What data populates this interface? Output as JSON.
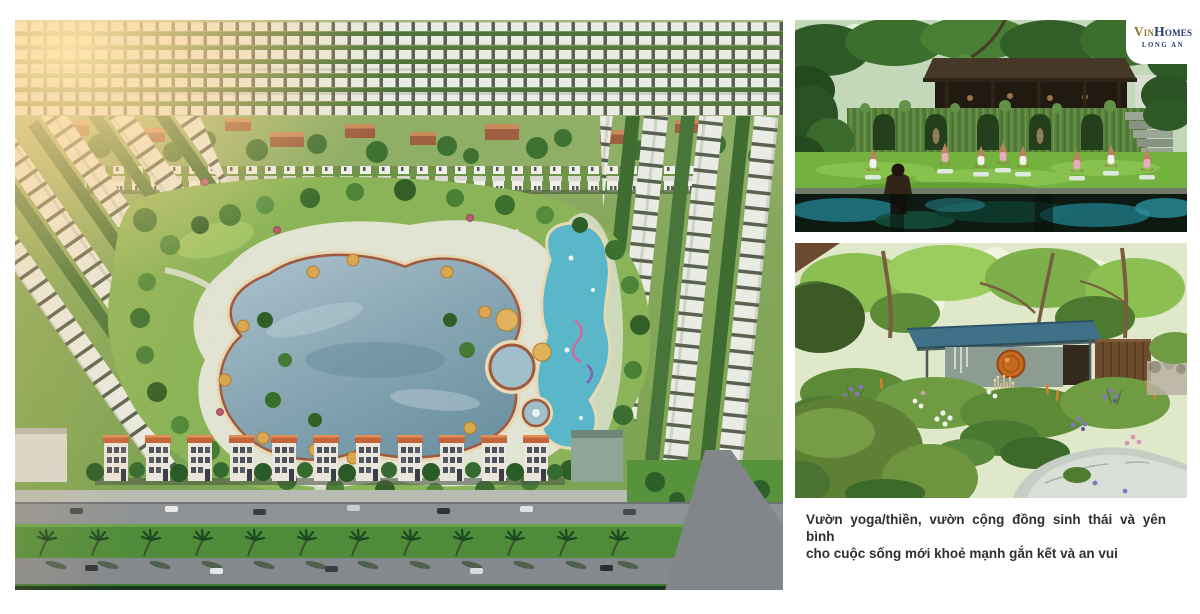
{
  "brand": {
    "vin": "Vin",
    "homes": "Homes",
    "subtitle": "LONG AN",
    "vin_color": "#96752c",
    "homes_color": "#263a72"
  },
  "caption": {
    "line1": "Vườn yoga/thiền, vườn cộng đồng sinh thái và yên bình",
    "line2": "cho cuộc sống mới khoẻ mạnh gắn kết và an vui",
    "text_color": "#2f2f2f"
  },
  "figures": {
    "masterplan_alt": "Aerial rendering of residential master plan with central lagoon pool, townhouse rows, central park and palm-lined boulevard",
    "yoga_alt": "Group yoga session on a lawn beside a dark reflecting pool in front of a vine-covered wall and wooden pavilion",
    "garden_alt": "Lush ecological community flower garden with winding stone path and teal-roofed pavilion with copper gong"
  }
}
